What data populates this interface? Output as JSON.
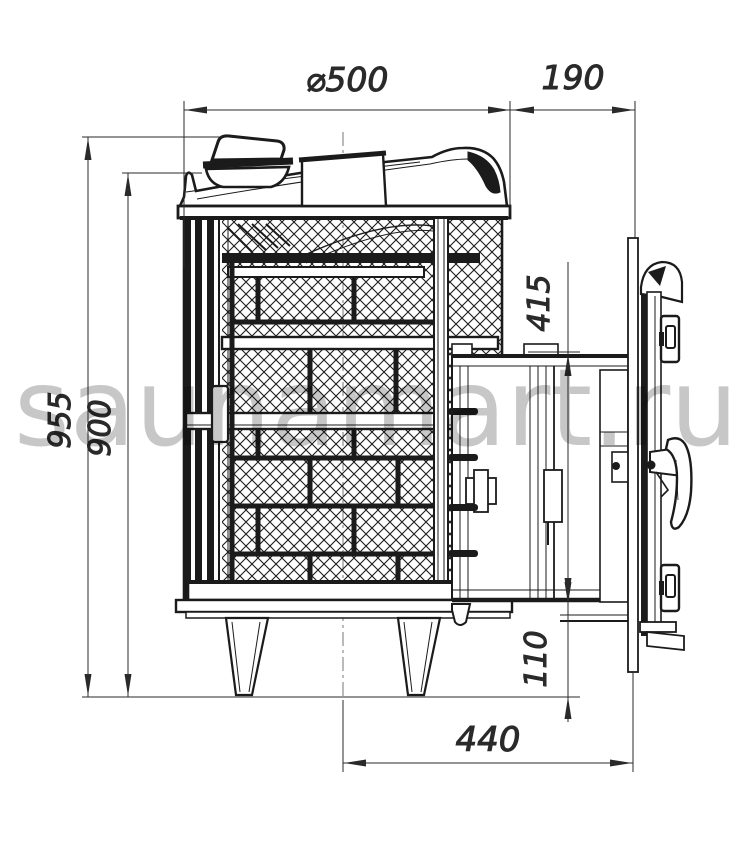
{
  "page": {
    "background": "#ffffff",
    "line_color": "#1b1b1b",
    "dim_color": "#2a2a2a"
  },
  "watermark": {
    "text": "saunamart.ru",
    "color": "#c7c7c7"
  },
  "drawing": {
    "subject": "sauna-stove-side-view-technical-drawing",
    "dimensions": {
      "diameter_top": {
        "label": "⌀500"
      },
      "top_right_offset": {
        "label": "190"
      },
      "overall_height": {
        "label": "955"
      },
      "body_height": {
        "label": "900"
      },
      "tunnel_height": {
        "label": "415"
      },
      "tunnel_clearance": {
        "label": "110"
      },
      "tunnel_reach": {
        "label": "440"
      }
    }
  }
}
